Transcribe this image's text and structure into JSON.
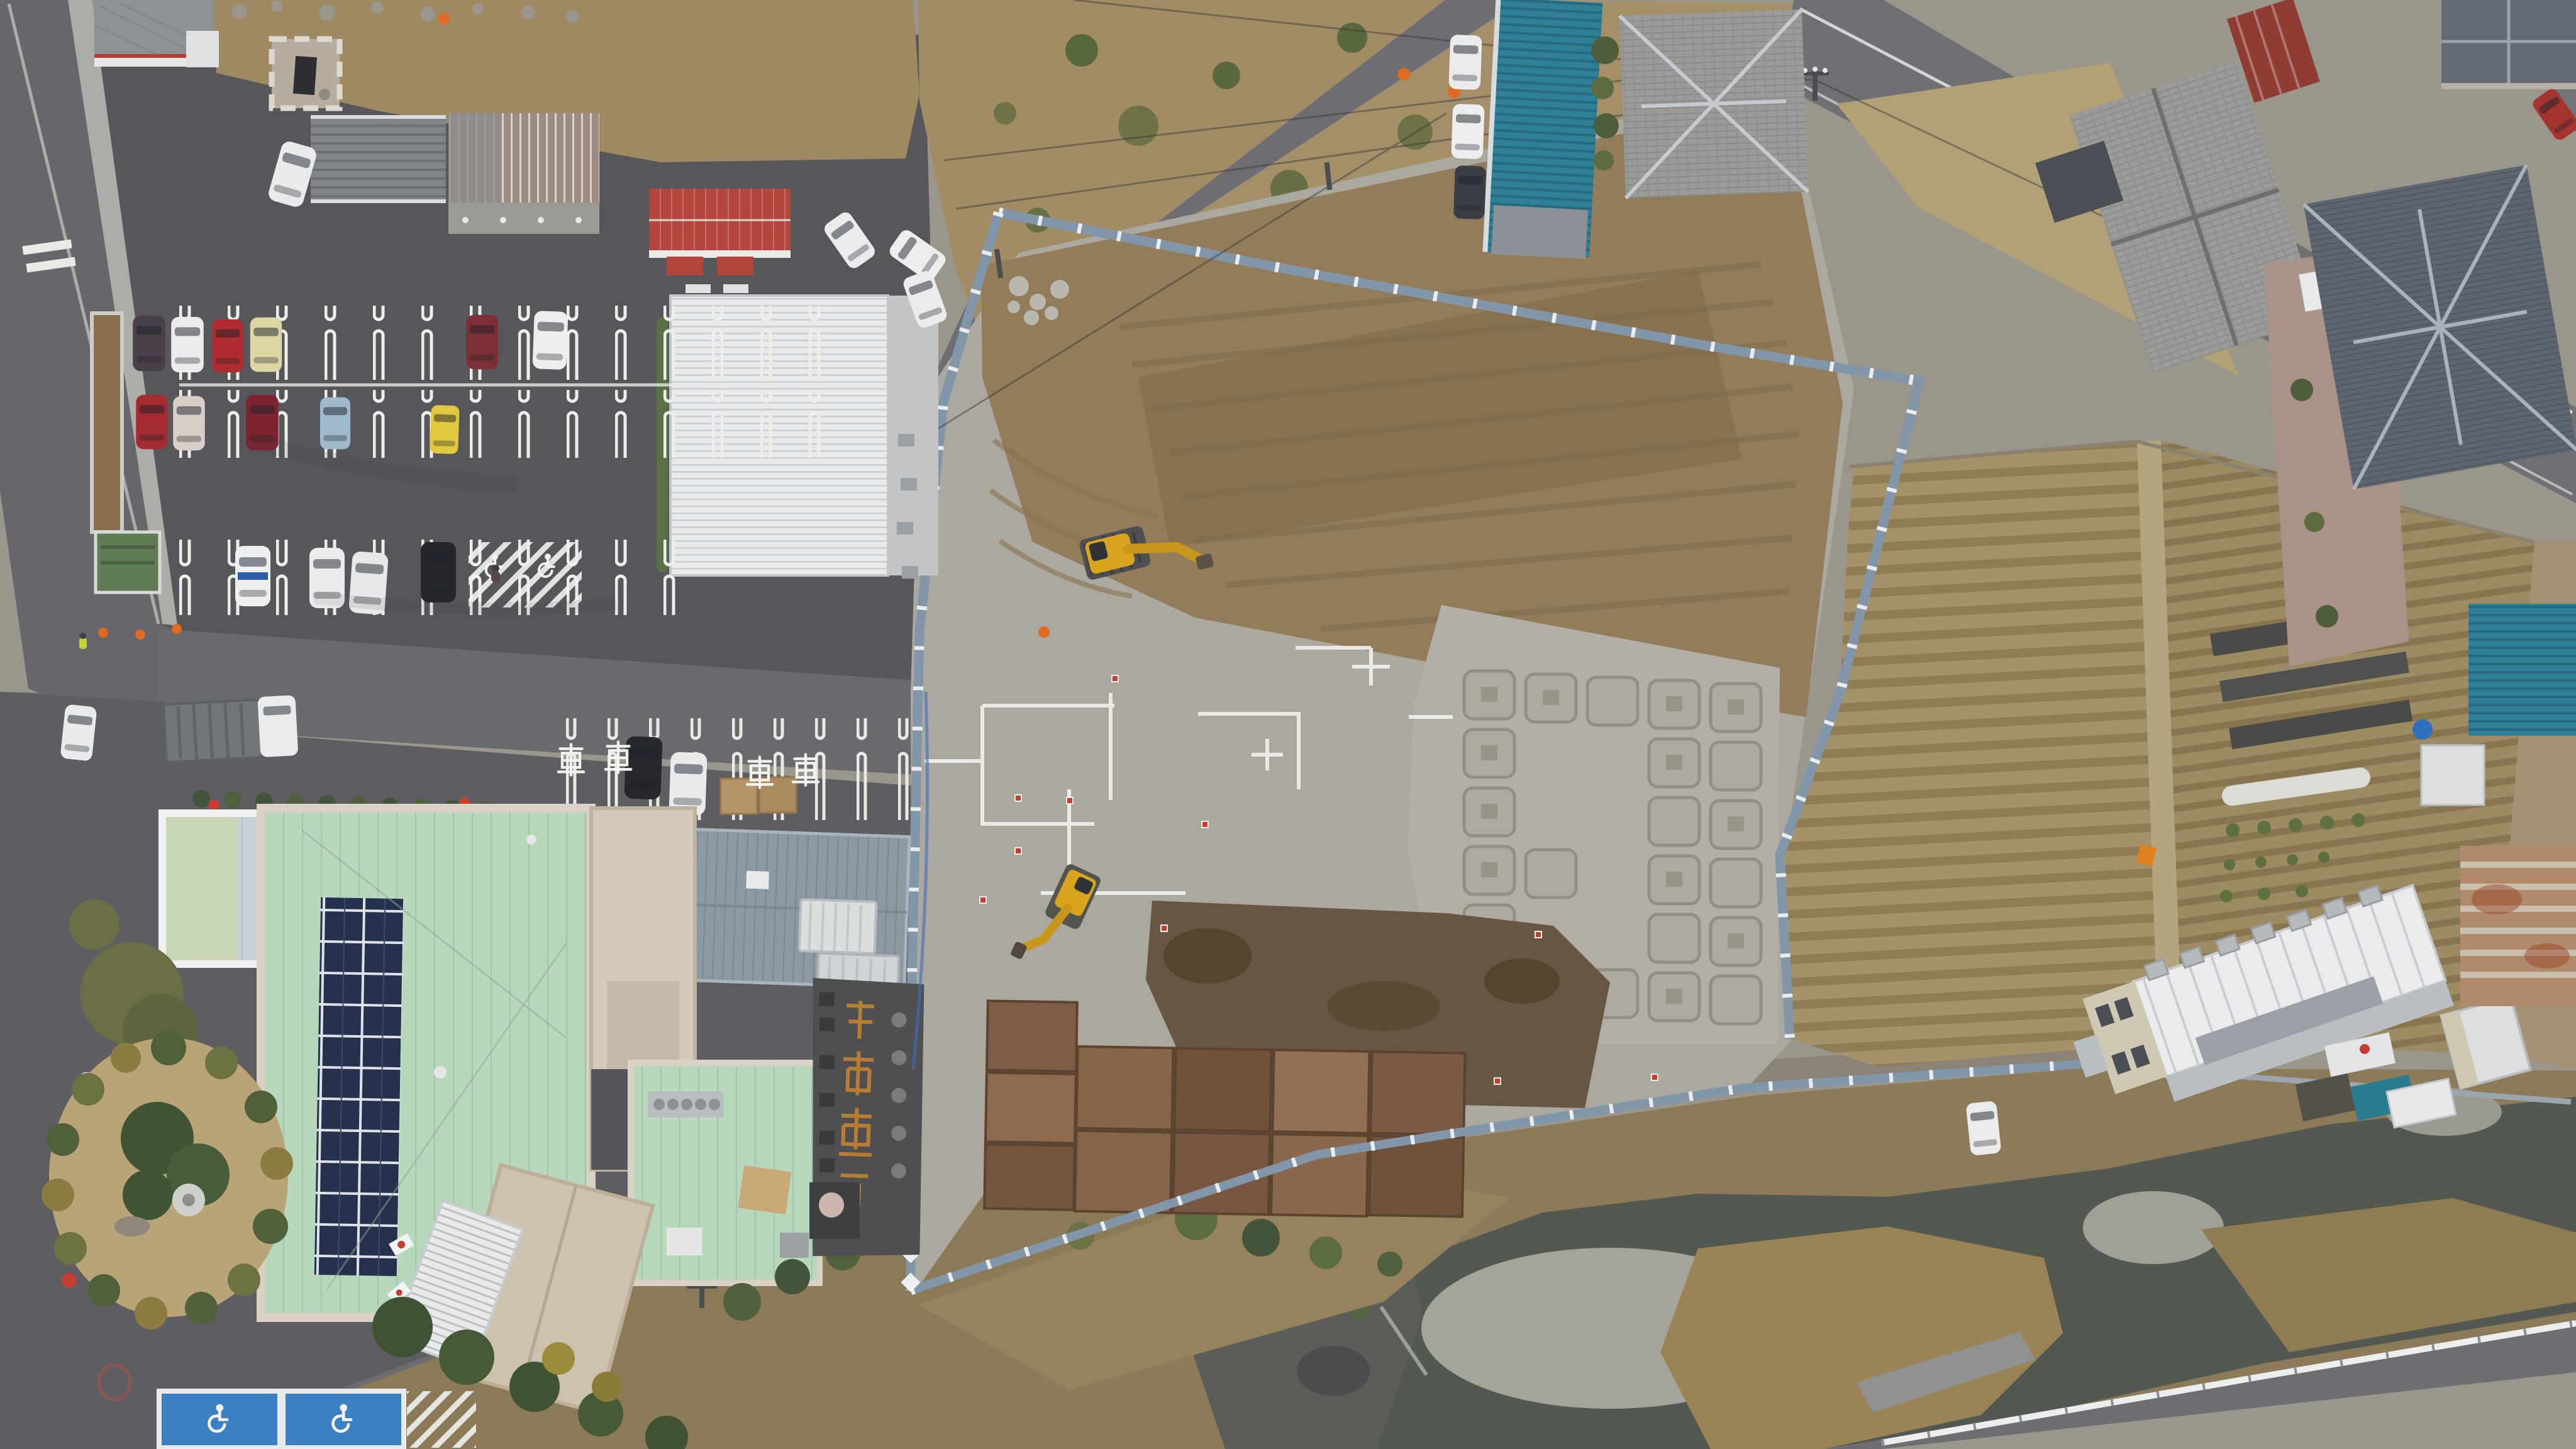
{
  "scene": {
    "description": "Aerial top-down drone photo of a Japanese riverside construction site beside a municipal facility, with parking lots, farm fields, tiled-roof houses and a river",
    "areas": {
      "top_left": "asphalt parking lot with striped stalls and parked cars",
      "center": "excavated construction site with gravel, brown earth, footing pads and steel road plates",
      "right": "plowed farm fields with mulch strips and row covers",
      "bottom": "river with gravel bars and dry reeds",
      "bottom_left": "mint-green flat-roof facility with solar panels and circular garden island"
    }
  },
  "markings": {
    "car_kanji": "車",
    "car_kanji_meaning": "car (painted parking stall marking)",
    "accessible_symbol": "wheelchair pavement marking",
    "sign_note": "faded orange kanji sign painted on old asphalt near site entrance"
  },
  "palette": {
    "asphalt": "#5e5e62",
    "road": "#6e6e72",
    "gravel_site": "#aba89f",
    "earth": "#927c59",
    "dark_soil": "#675643",
    "mint_roof": "#b7d7bb",
    "solar_panel": "#27314d",
    "teal_roof": "#2f7f96",
    "red_roof": "#b2463c",
    "warehouse_roof": "#e7e9eb",
    "water": "#535951",
    "temp_fence": "#8296a9",
    "field": "#a29068",
    "excavator": "#d9a41e"
  },
  "objects": {
    "excavators": 2,
    "parked_cars_main_lot": 15,
    "white_vans": 6,
    "accessible_stalls": 2,
    "steel_road_plates": 11,
    "footing_pad_grid": "5 x 6 squares",
    "traffic_cones_and_stakes": 18,
    "flags": 2,
    "pedestrians": 2
  }
}
